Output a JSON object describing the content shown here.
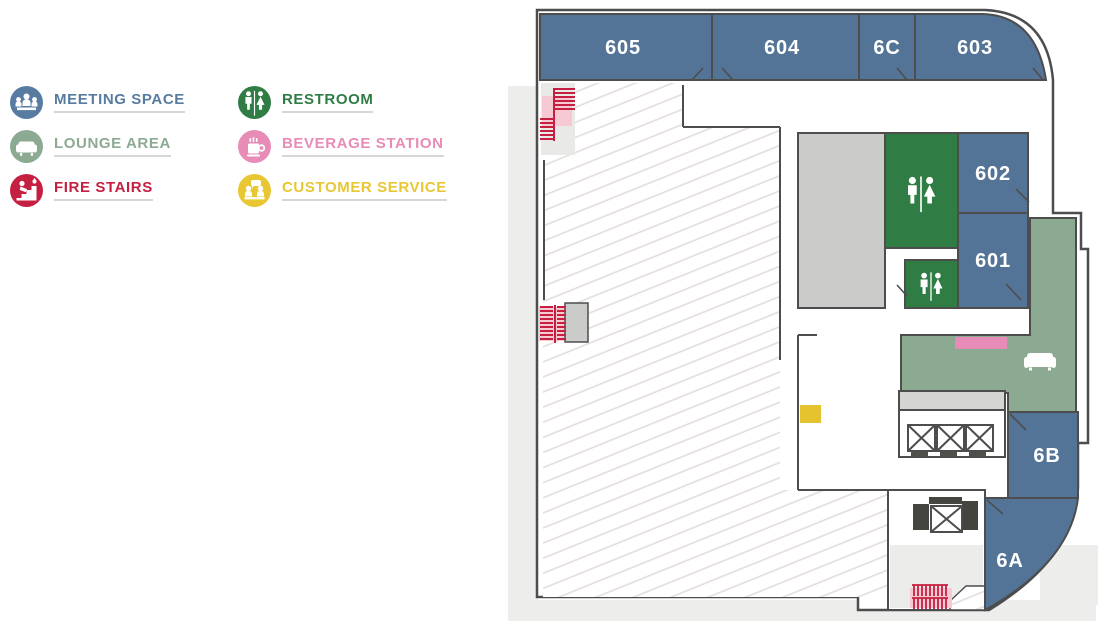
{
  "legend": {
    "items": [
      {
        "label": "MEETING SPACE",
        "color": "#587ca1",
        "icon": "meeting-space-icon"
      },
      {
        "label": "LOUNGE AREA",
        "color": "#8caa92",
        "icon": "lounge-area-icon"
      },
      {
        "label": "FIRE STAIRS",
        "color": "#c51f41",
        "icon": "fire-stairs-icon"
      },
      {
        "label": "RESTROOM",
        "color": "#2f7d45",
        "icon": "restroom-icon"
      },
      {
        "label": "BEVERAGE STATION",
        "color": "#e78cb6",
        "icon": "beverage-station-icon"
      },
      {
        "label": "CUSTOMER SERVICE",
        "color": "#e9c733",
        "icon": "customer-service-icon"
      }
    ]
  },
  "floorplan": {
    "rooms": [
      {
        "id": "605",
        "label": "605",
        "type": "meeting-space"
      },
      {
        "id": "604",
        "label": "604",
        "type": "meeting-space"
      },
      {
        "id": "6C",
        "label": "6C",
        "type": "meeting-space"
      },
      {
        "id": "603",
        "label": "603",
        "type": "meeting-space"
      },
      {
        "id": "602",
        "label": "602",
        "type": "meeting-space"
      },
      {
        "id": "601",
        "label": "601",
        "type": "meeting-space"
      },
      {
        "id": "6B",
        "label": "6B",
        "type": "meeting-space"
      },
      {
        "id": "6A",
        "label": "6A",
        "type": "meeting-space"
      }
    ],
    "features": [
      {
        "name": "restroom-large",
        "icon": "restroom-icon"
      },
      {
        "name": "restroom-small",
        "icon": "restroom-icon"
      },
      {
        "name": "lounge-area",
        "icon": "sofa-icon"
      },
      {
        "name": "beverage-station",
        "icon": "beverage-station-marker"
      },
      {
        "name": "customer-service",
        "icon": "customer-service-marker"
      },
      {
        "name": "fire-stairs-northwest",
        "icon": "fire-stairs-icon"
      },
      {
        "name": "fire-stairs-west",
        "icon": "fire-stairs-icon"
      },
      {
        "name": "fire-stairs-south",
        "icon": "fire-stairs-icon"
      },
      {
        "name": "elevator-bank",
        "icon": "elevator-icon",
        "count": 3
      },
      {
        "name": "service-elevator",
        "icon": "elevator-icon",
        "count": 1
      }
    ],
    "colors": {
      "room_blue": "#537496",
      "restroom_green": "#2f7d45",
      "lounge_green": "#8caa92",
      "beverage_pink": "#e78cb6",
      "stair_red": "#c51f41",
      "stair_pink": "#f7c9d2",
      "service_yellow": "#e4c32e",
      "core_gray": "#cbcbc9",
      "strip_gray": "#d4d4d2",
      "lower_gray": "#ececea",
      "patch_gray": "#e9e9e8",
      "pavement_gray": "#ededec",
      "wall": "#4d4d4d",
      "white": "#ffffff"
    }
  }
}
